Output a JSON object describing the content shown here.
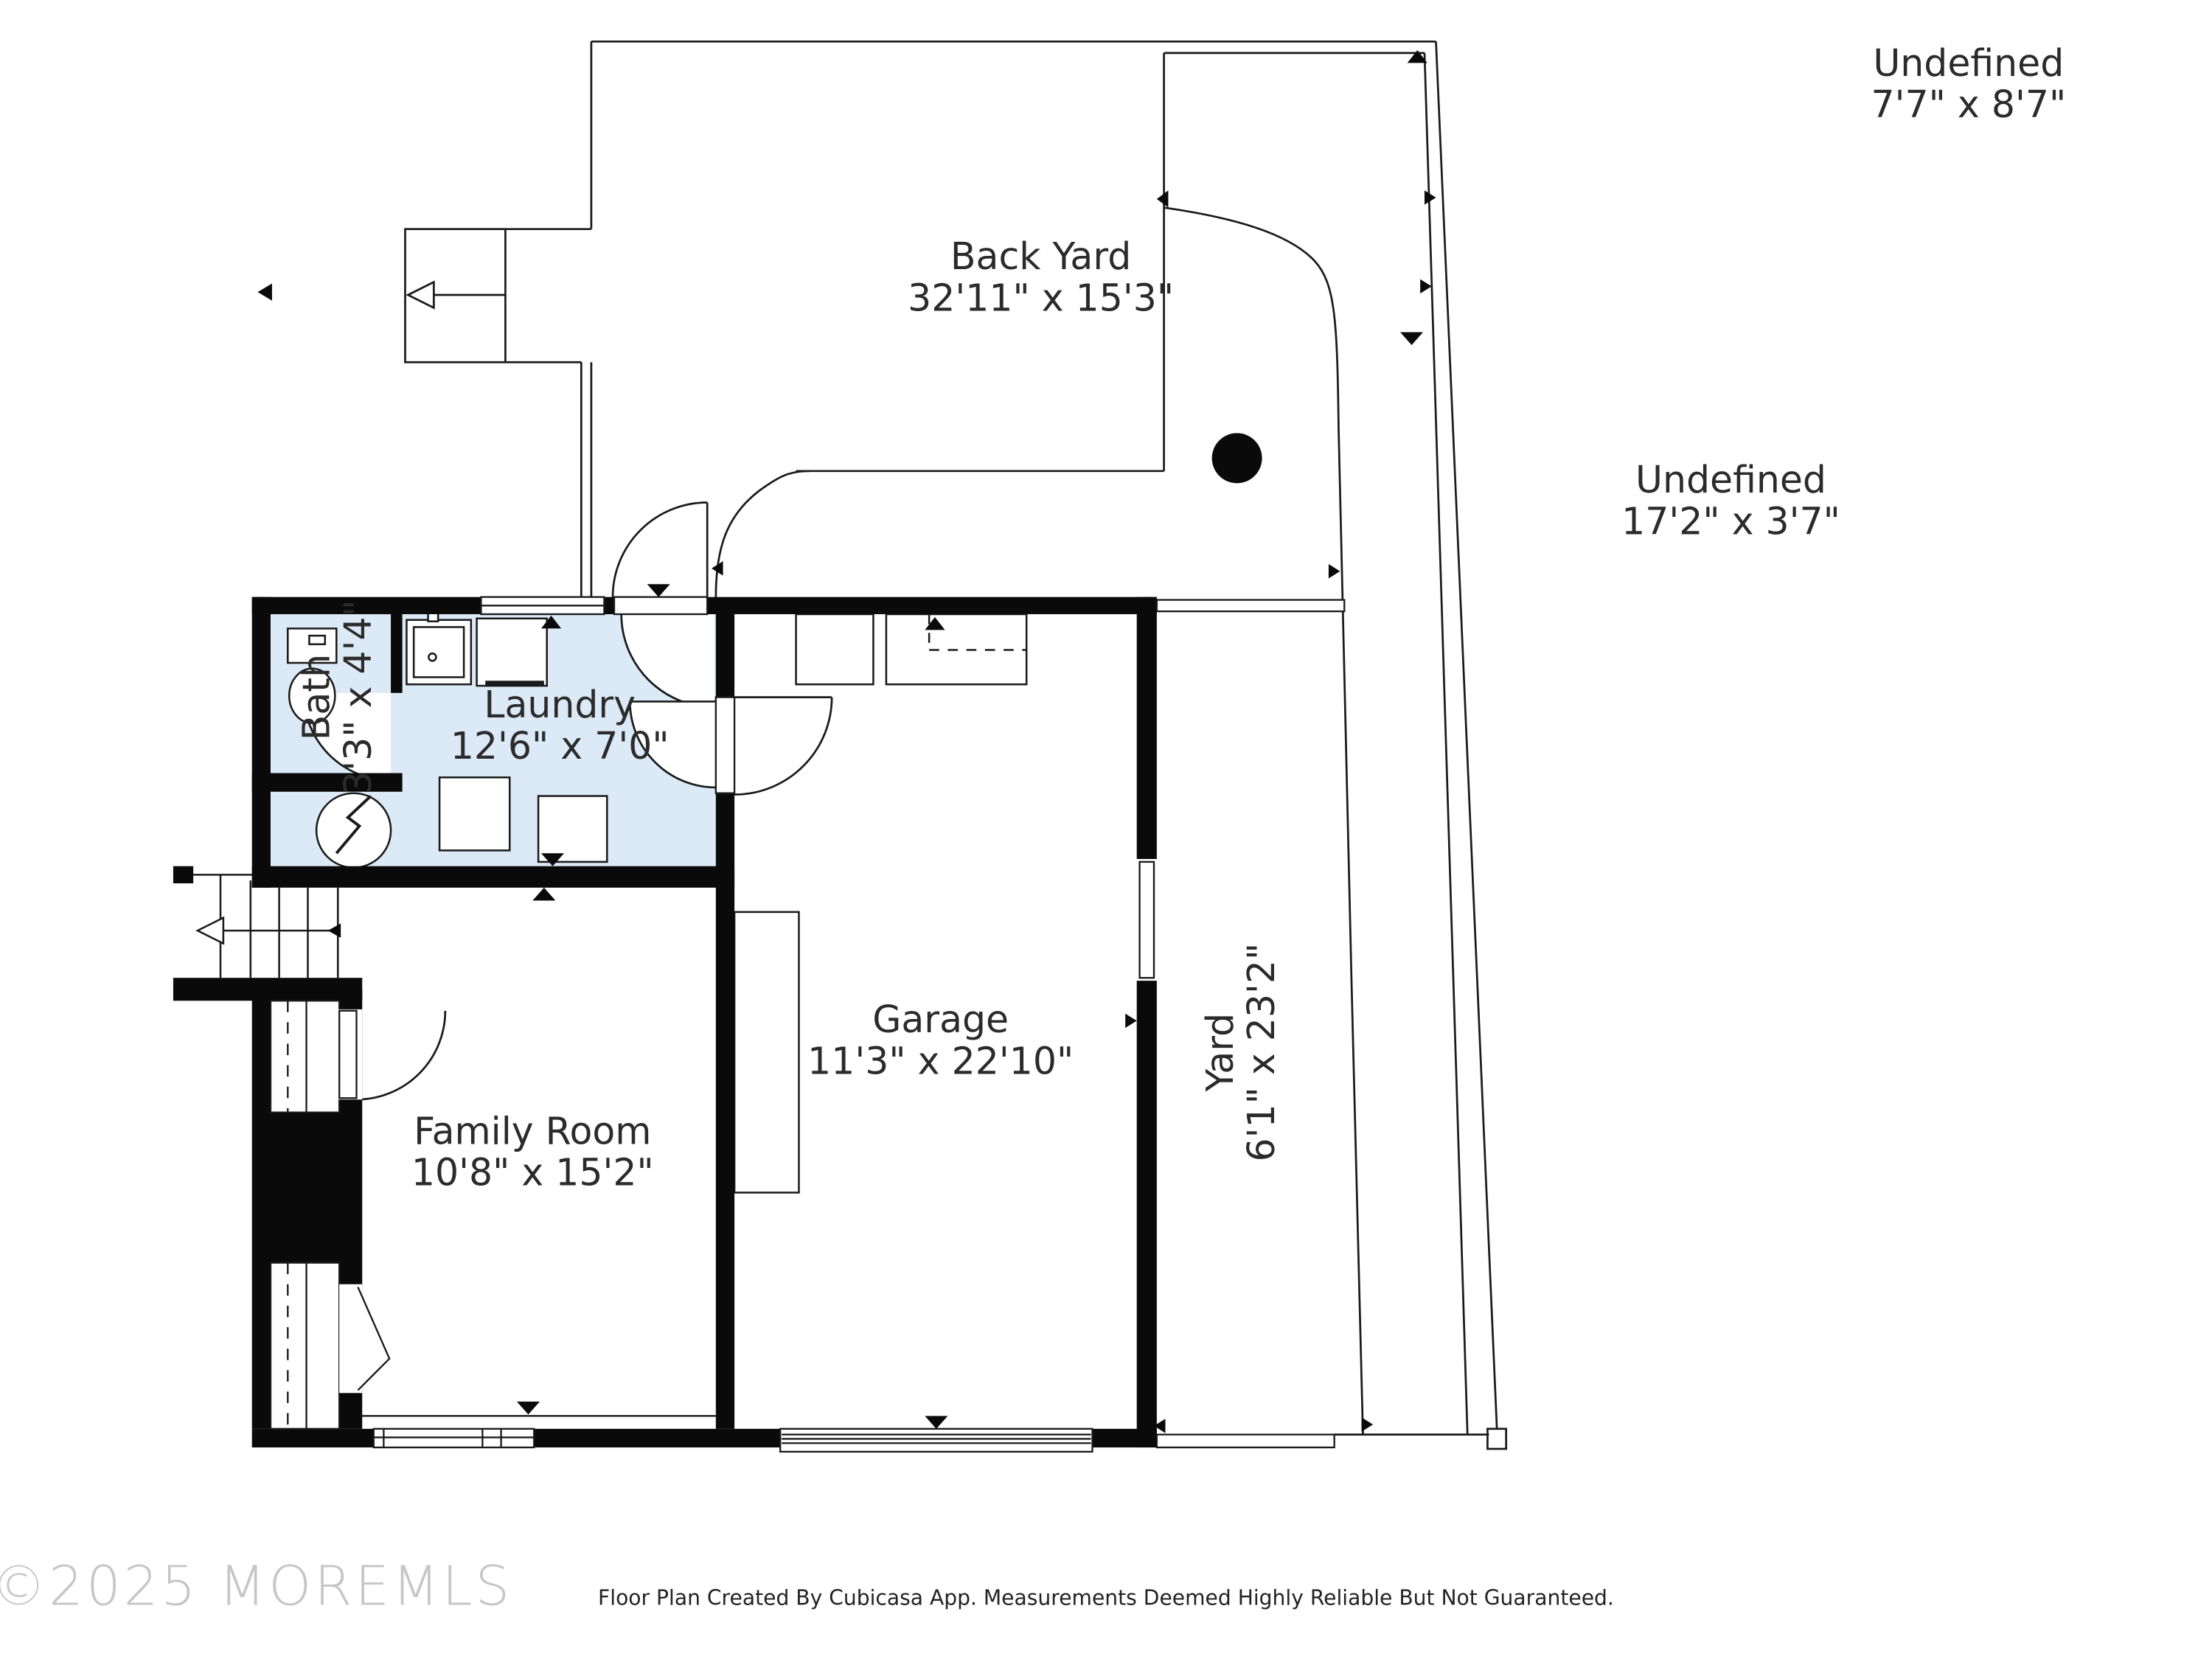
{
  "page": {
    "background": "#ffffff",
    "type": "floor-plan"
  },
  "branding": {
    "copyright": "©2025 MOREMLS",
    "disclaimer": "Floor Plan Created By Cubicasa App. Measurements Deemed Highly Reliable But Not Guaranteed."
  },
  "rooms": [
    {
      "key": "back-yard",
      "name": "Back Yard",
      "dims": "32'11\" x 15'3\""
    },
    {
      "key": "laundry",
      "name": "Laundry",
      "dims": "12'6\" x 7'0\""
    },
    {
      "key": "bath",
      "name": "Bath",
      "dims": "3'3\" x 4'4\""
    },
    {
      "key": "garage",
      "name": "Garage",
      "dims": "11'3\" x 22'10\""
    },
    {
      "key": "family-room",
      "name": "Family Room",
      "dims": "10'8\" x 15'2\""
    },
    {
      "key": "yard",
      "name": "Yard",
      "dims": "6'1\" x 23'2\""
    },
    {
      "key": "undefined-upper",
      "name": "Undefined",
      "dims": "7'7\" x 8'7\""
    },
    {
      "key": "undefined-side",
      "name": "Undefined",
      "dims": "17'2\" x 3'7\""
    }
  ],
  "colors": {
    "wet_room_fill": "#dbeaf6",
    "wall": "#0a0a0a",
    "line": "#1a1a1a",
    "label_text": "#2b2b2b",
    "watermark": "#c6c6c6",
    "footer_text": "#222222"
  },
  "symbols": {
    "water_heater": "circle-with-lightning-bolt",
    "doors": "quarter-arc-swings",
    "stairs": "treads-with-left-arrow",
    "tree": "solid-black-dot"
  }
}
